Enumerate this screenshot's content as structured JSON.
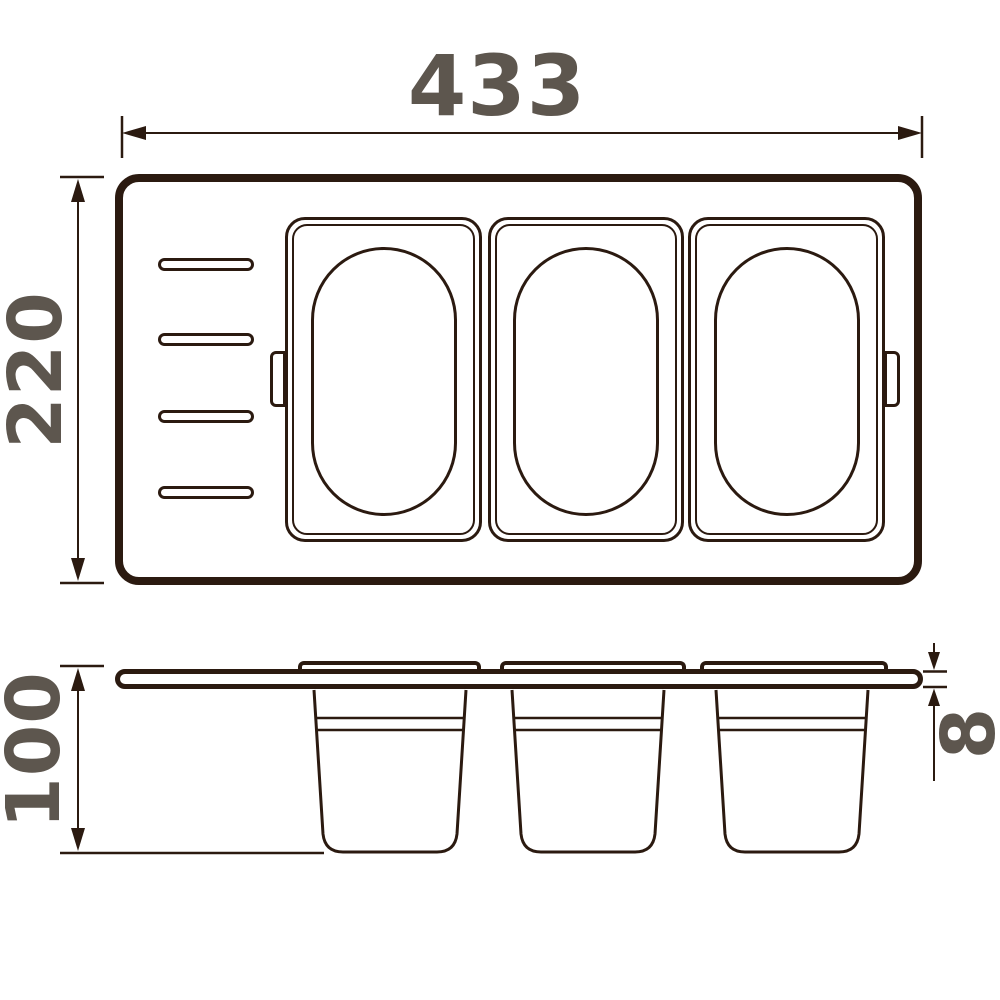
{
  "drawing": {
    "dimensions": {
      "width": "433",
      "depth": "220",
      "cup_height": "100",
      "panel_thickness": "8"
    },
    "colors": {
      "line": "#2b1a10",
      "dimension_label": "#5d564e",
      "background": "#ffffff"
    },
    "views": {
      "top": {
        "container_count": 3,
        "slot_count": 4,
        "tab_count": 2
      },
      "side": {
        "cup_count": 3,
        "flange_count": 3
      }
    }
  }
}
